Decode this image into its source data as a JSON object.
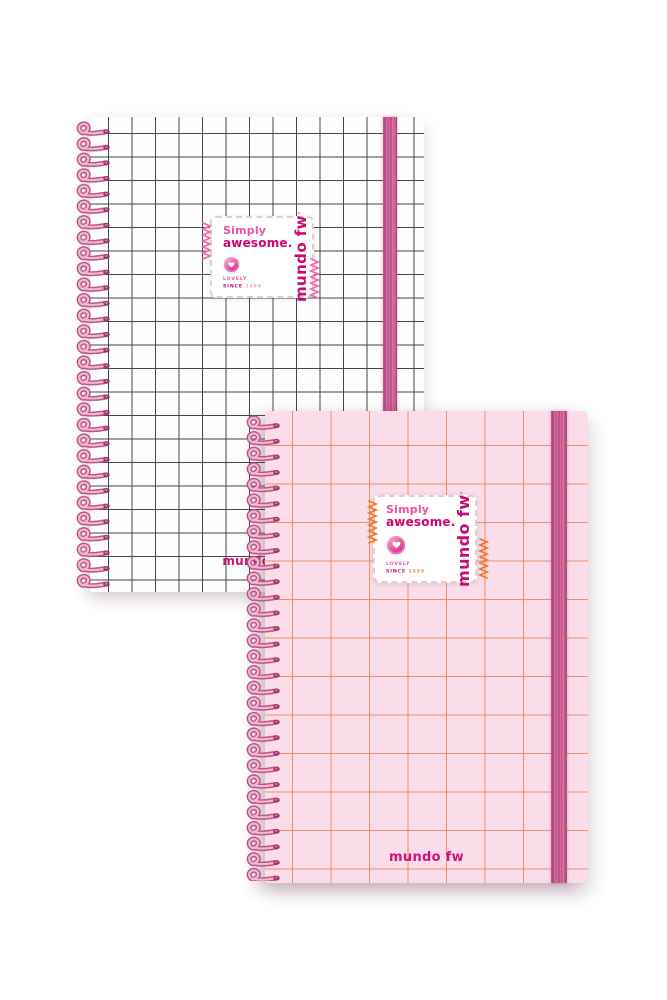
{
  "label": {
    "simply": "Simply",
    "awesome": "awesome.",
    "lovely": "LOVELY",
    "since_word": "SINCE",
    "since_year": "1989",
    "brand_vertical": "mundo fw",
    "brand_mark": "’"
  },
  "notebooks": [
    {
      "name": "white-grid-notebook",
      "bottom_logo": "mundo fw",
      "cover_color": "#fefefe",
      "grid_color": "#474747",
      "elastic_color": "#c04e87",
      "spiral_color": "#e998bf",
      "spring_color": "#f26ba9",
      "year_color": "#f29ec6"
    },
    {
      "name": "pink-grid-notebook",
      "bottom_logo": "mundo fw",
      "cover_color": "#fbdce9",
      "grid_color": "#ef8f6a",
      "elastic_color": "#c04e87",
      "spiral_color": "#e998bf",
      "spring_color": "#ef7830",
      "year_color": "#ef8f5a"
    }
  ],
  "colors": {
    "background": "#ffffff",
    "brand_magenta": "#d2107e",
    "label_border": "#d6d3d3"
  }
}
